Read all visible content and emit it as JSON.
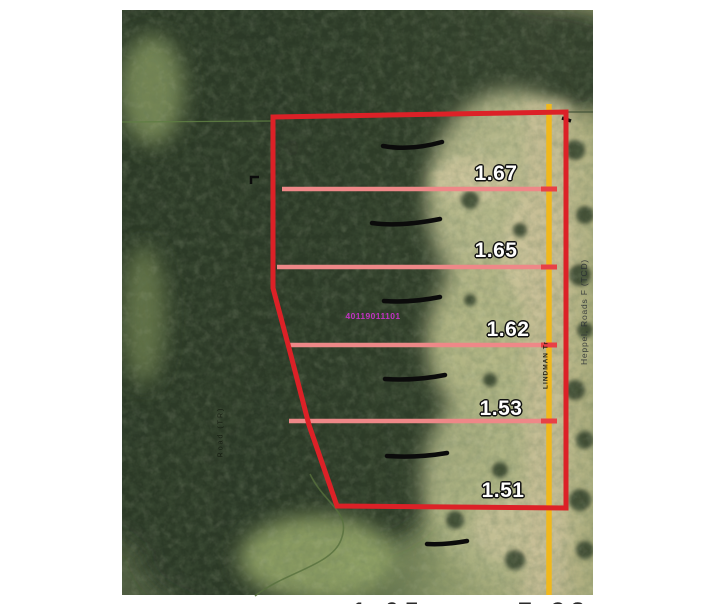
{
  "map": {
    "parcel_id_label": "40119011101",
    "parcels": [
      {
        "acreage": "1.67",
        "x": 496,
        "y": 174
      },
      {
        "acreage": "1.65",
        "x": 496,
        "y": 251
      },
      {
        "acreage": "1.62",
        "x": 508,
        "y": 330
      },
      {
        "acreage": "1.53",
        "x": 501,
        "y": 409
      },
      {
        "acreage": "1.51",
        "x": 503,
        "y": 491
      }
    ],
    "road_labels": {
      "right_vertical": "Heppel, Roads F (TCD)",
      "on_yellow_line": "LINDMAN Tr",
      "left_vertical": "Road (TR)"
    },
    "cutoff_values": {
      "left": "1.05",
      "right": "7.38"
    },
    "colors": {
      "boundary_red": "#dc2127",
      "divider_pink": "#ee8888",
      "road_yellow": "#f0b81c",
      "parcel_id_magenta": "#c233c2",
      "survey_green": "#5e7d43"
    }
  }
}
